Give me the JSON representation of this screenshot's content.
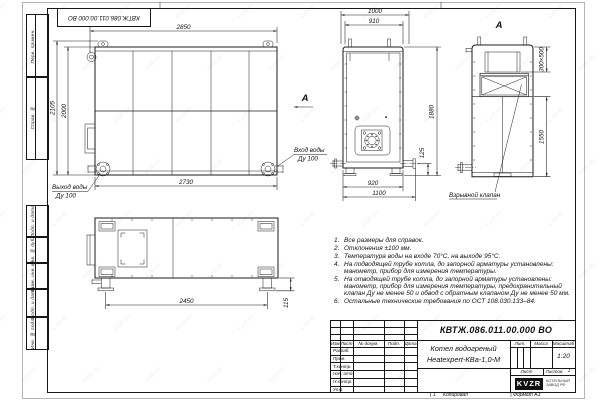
{
  "meta": {
    "doc_number": "КВТЖ.086.011.00.000 ВО",
    "product_name_line1": "Котел водогреный",
    "product_name_line2": "Heatexpert-КВа-1,0-М",
    "scale_value": "1:20",
    "sheets_value": "1",
    "zone_mark": "1",
    "copied_label": "Копировал",
    "format_label": "Формат А3",
    "logo_text": "KVZR",
    "logo_caption_line1": "КОТЕЛЬНЫЙ",
    "logo_caption_line2": "ЗАВОД РФ",
    "watermark": "KVZR.RU"
  },
  "margin_stamps": {
    "perv_primen": "Перв. примен.",
    "sprav_no": "Справ. №",
    "podp_data_1": "Подп. и дата",
    "inv_dubl": "Инв. № дубл.",
    "vzam_inv": "Взам. инв. №",
    "podp_data_2": "Подп. и дата",
    "inv_podl": "Инв. № подл."
  },
  "titleblock": {
    "header": {
      "izm": "Изм.",
      "list": "Лист",
      "doc": "№ докум.",
      "podp": "Подп.",
      "data": "Дата"
    },
    "sig_rows": [
      "Разраб.",
      "Пров.",
      "Т.контр.",
      "Нач. отд.",
      "Н.контр.",
      "Утв."
    ],
    "lit_label": "Лит.",
    "mass_label": "Масса",
    "scale_label": "Масштаб",
    "sheet_label": "Лист",
    "sheets_label": "Листов"
  },
  "views": {
    "side": {
      "dim_top": "2850",
      "dim_left_outer": "2105",
      "dim_left_inner": "2000",
      "dim_bottom": "2730",
      "outlet_label_1": "Выход воды",
      "outlet_label_2": "Ду 100"
    },
    "direction_arrow_label": "А",
    "front": {
      "dim_top": "1000",
      "dim_top2": "910",
      "dim_right": "1880",
      "dim_right_small": "125",
      "dim_bottom": "920",
      "dim_bottom2": "1100",
      "inlet_label_1": "Вход воды",
      "inlet_label_2": "Ду 100"
    },
    "view_a": {
      "label": "А",
      "dim_duct": "300×500",
      "dim_height": "1550",
      "valve_label": "Взрывной клапан"
    },
    "plan": {
      "dim_length": "2450",
      "dim_height": "115"
    }
  },
  "notes": [
    {
      "n": "1.",
      "text": "Все размеры для справок."
    },
    {
      "n": "2.",
      "text": "Отклонения ±100 мм."
    },
    {
      "n": "3.",
      "text": "Температура воды на входе 70°С, на выходе 95°С."
    },
    {
      "n": "4.",
      "text": "На подводящей трубе котла, до запорной арматуры установлены: манометр, прибор для измерения температуры."
    },
    {
      "n": "5.",
      "text": "На отводящей трубе котла, до запорной арматуры установлены: манометр, прибор для измерения температуры, предохранительный клапан Ду не менее 50 и обвод с обратным клапаном Ду не менее 50 мм."
    },
    {
      "n": "6.",
      "text": "Остальные технические требования по ОСТ 108.030.133–84."
    }
  ]
}
